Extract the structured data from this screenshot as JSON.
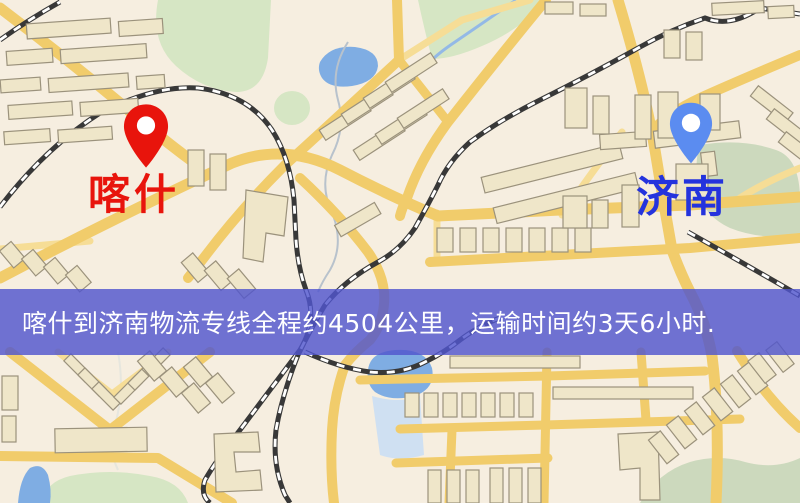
{
  "map": {
    "colors": {
      "background": "#f6eee0",
      "road": "#f1cc6b",
      "road_minor": "#f6dd96",
      "building_fill": "#efe6c9",
      "building_stroke": "#9b927c",
      "railway": "#383838",
      "water": "#7fade3",
      "park": "#d6e6c4",
      "park_muted": "#ccd9bd"
    }
  },
  "markers": {
    "origin": {
      "name": "喀什",
      "pin_color": "#e8140c",
      "label_color": "#e8140c"
    },
    "destination": {
      "name": "济南",
      "pin_color": "#5b8cf0",
      "label_color": "#2433dd"
    }
  },
  "route_banner": {
    "text": "喀什到济南物流专线全程约4504公里，运输时间约3天6小时.",
    "origin": "喀什",
    "destination": "济南",
    "distance_km": "4504",
    "transit_time": "3天6小时",
    "background_color": "#5056cd",
    "text_color": "#ffffff"
  }
}
